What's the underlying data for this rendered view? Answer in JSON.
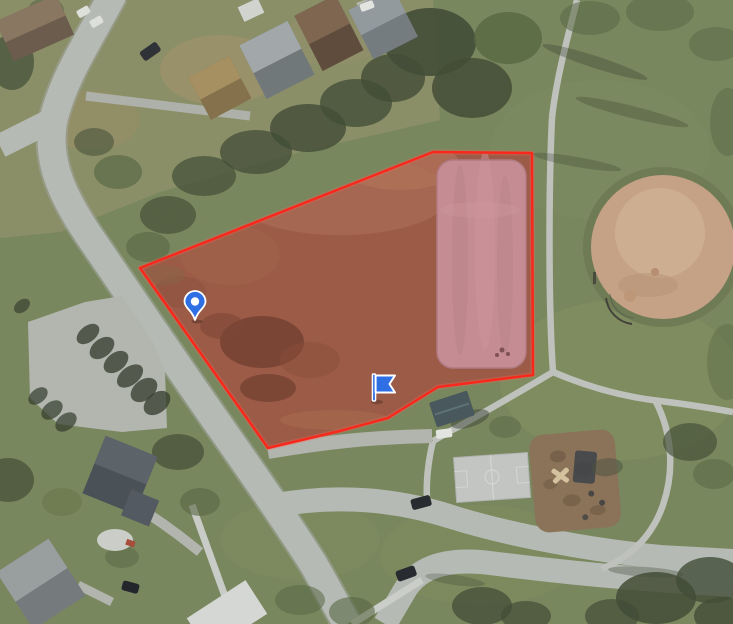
{
  "map": {
    "view": "satellite-aerial",
    "colors": {
      "parcel_outline": "#ff2416",
      "parcel_glow": "#ff6a5a",
      "parcel_fill": "rgba(255,30,20,0.10)",
      "dirt_field": "#93604a",
      "rink": "#c39ba3",
      "rink_border": "#aa858d",
      "marker_blue": "#2f6fe4",
      "marker_outline": "#ffffff",
      "grass": "#79875d",
      "road": "#b9bdb7",
      "path": "#c3c6bf",
      "infield": "#c9a385",
      "court": "#c6c9c5",
      "playground_mulch": "#8b7257"
    },
    "parcel": {
      "description": "selected parcel highlighted in red",
      "points": "140,268 433,152 532,153 533,375 438,387 388,418 340,431 268,448"
    },
    "markers": {
      "pin": {
        "x": 195,
        "y": 320,
        "transform": "translate(195,320)"
      },
      "flag": {
        "x": 374,
        "y": 401,
        "transform": "translate(374,401)"
      }
    },
    "landmarks": [
      {
        "name": "baseball-field"
      },
      {
        "name": "basketball-court"
      },
      {
        "name": "playground"
      },
      {
        "name": "parking-lot"
      },
      {
        "name": "park-building"
      },
      {
        "name": "residential-area"
      }
    ]
  }
}
